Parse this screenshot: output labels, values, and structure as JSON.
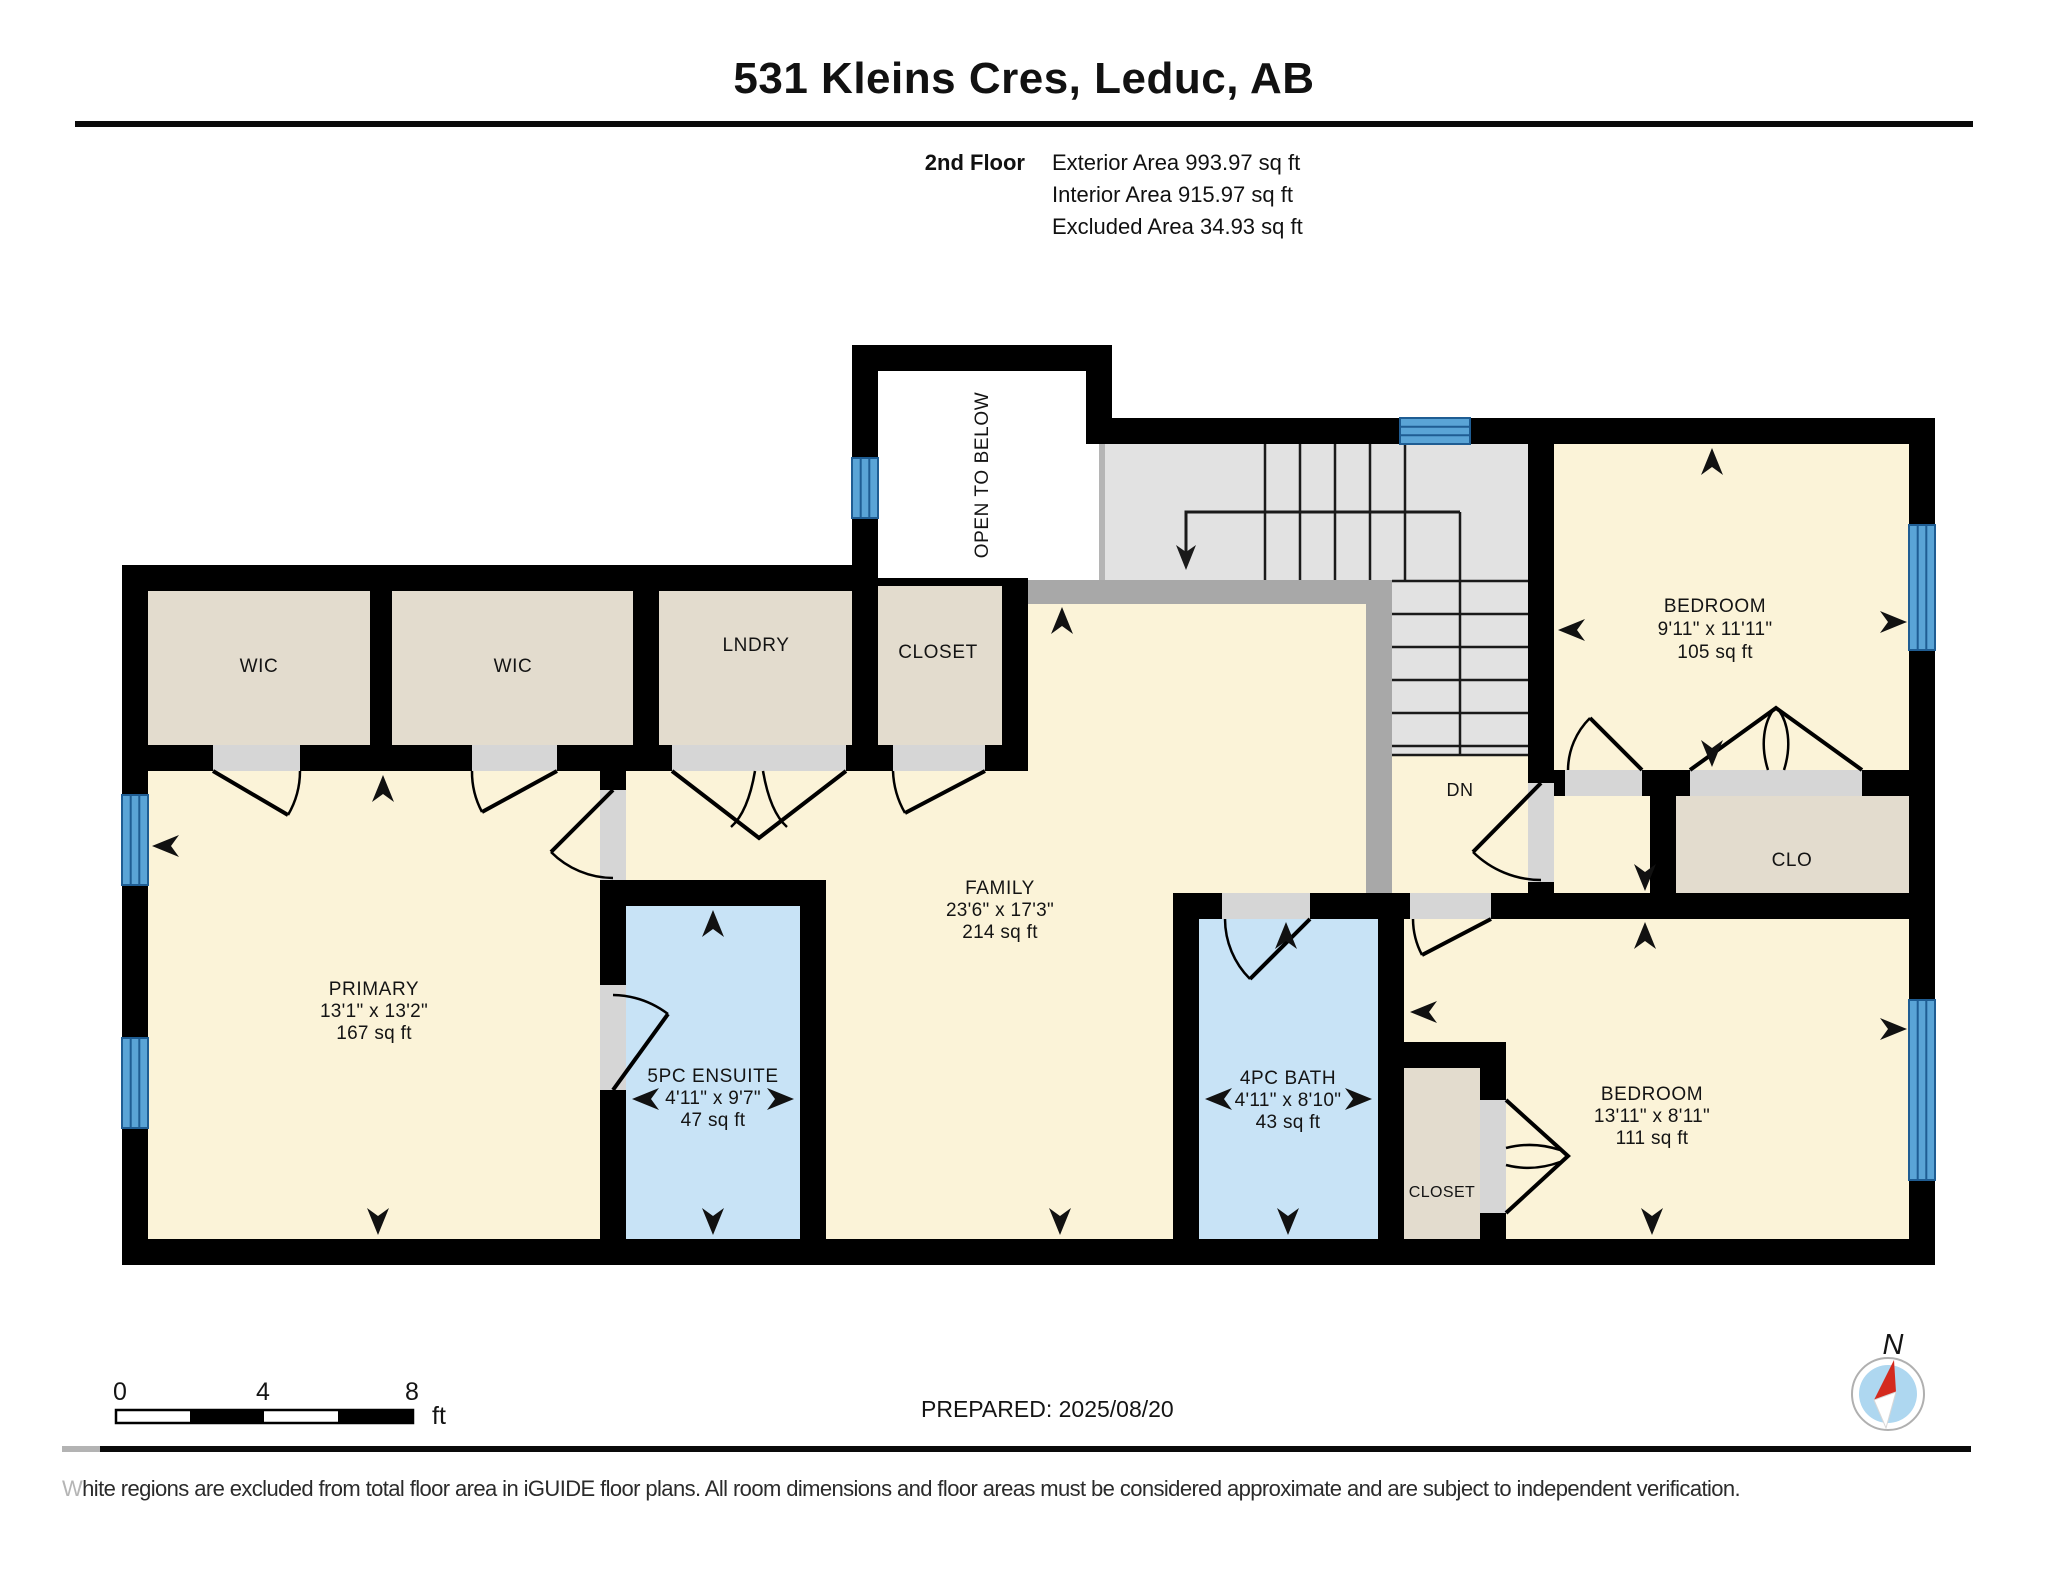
{
  "header": {
    "title": "531 Kleins Cres, Leduc, AB",
    "floor_label": "2nd Floor",
    "areas": [
      "Exterior Area 993.97 sq ft",
      "Interior Area 915.97 sq ft",
      "Excluded Area 34.93 sq ft"
    ]
  },
  "rooms": {
    "wic_left": {
      "label": "WIC"
    },
    "wic_right": {
      "label": "WIC"
    },
    "laundry": {
      "label": "LNDRY"
    },
    "closet_hall": {
      "label": "CLOSET"
    },
    "open_to_below": {
      "label": "OPEN TO BELOW"
    },
    "bedroom_top": {
      "label": "BEDROOM",
      "dims": "9'11\" x 11'11\"",
      "area": "105 sq ft"
    },
    "primary": {
      "label": "PRIMARY",
      "dims": "13'1\" x 13'2\"",
      "area": "167 sq ft"
    },
    "ensuite": {
      "label": "5PC ENSUITE",
      "dims": "4'11\" x 9'7\"",
      "area": "47 sq ft"
    },
    "family": {
      "label": "FAMILY",
      "dims": "23'6\" x 17'3\"",
      "area": "214 sq ft"
    },
    "bath": {
      "label": "4PC BATH",
      "dims": "4'11\" x 8'10\"",
      "area": "43 sq ft"
    },
    "closet_bottom": {
      "label": "CLOSET"
    },
    "clo": {
      "label": "CLO"
    },
    "bedroom_bottom": {
      "label": "BEDROOM",
      "dims": "13'11\" x 8'11\"",
      "area": "111 sq ft"
    },
    "stairs": {
      "label": "DN"
    }
  },
  "scale_bar": {
    "ticks": [
      "0",
      "4",
      "8"
    ],
    "unit": "ft"
  },
  "compass": {
    "north_label": "N"
  },
  "footer": {
    "prepared": "PREPARED: 2025/08/20",
    "disclaimer_lead": "W",
    "disclaimer_rest": "hite regions are excluded from total floor area in iGUIDE floor plans. All room dimensions and floor areas must be considered approximate and are subject to independent verification."
  },
  "colors": {
    "wall": "#000000",
    "room_yellow": "#fbf3d8",
    "room_beige": "#e3dcce",
    "room_blue": "#c8e3f6",
    "stair_gray": "#e2e2e2",
    "railing_gray": "#a8a8a8",
    "door_gap_gray": "#d6d6d6",
    "window_blue": "#5aa4d6",
    "window_line": "#1f5d93",
    "compass_red": "#d42a1e",
    "compass_fill": "#aed7f0"
  }
}
